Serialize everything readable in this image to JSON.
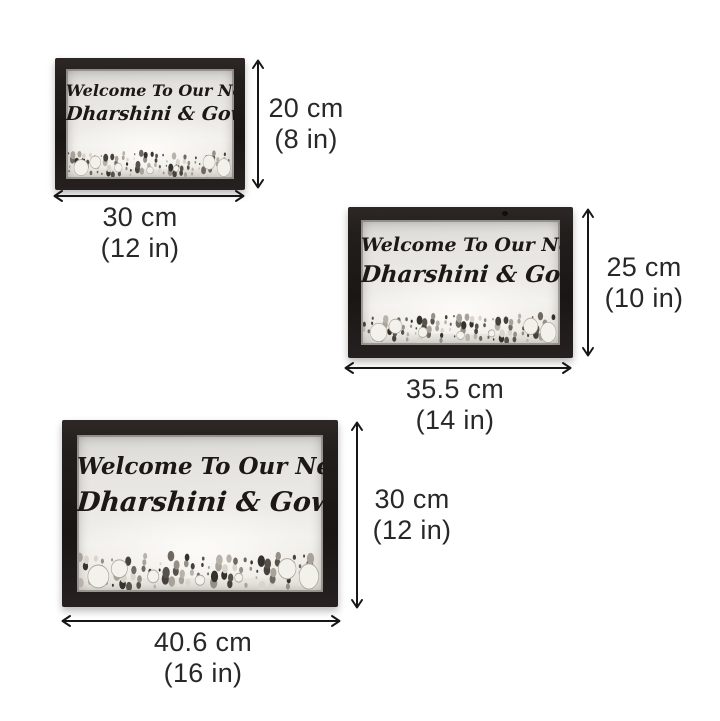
{
  "product": {
    "sign": {
      "line1": "Welcome To Our Nest",
      "line2": "Dharshini & Gowtham"
    }
  },
  "sizes": [
    {
      "label": "small",
      "height": {
        "value": "20 cm",
        "alt": "(8 in)"
      },
      "width": {
        "value": "30 cm",
        "alt": "(12 in)"
      }
    },
    {
      "label": "medium",
      "height": {
        "value": "25 cm",
        "alt": "(10 in)"
      },
      "width": {
        "value": "35.5 cm",
        "alt": "(14 in)"
      }
    },
    {
      "label": "large",
      "height": {
        "value": "30 cm",
        "alt": "(12 in)"
      },
      "width": {
        "value": "40.6 cm",
        "alt": "(16 in)"
      }
    }
  ],
  "colors": {
    "page_bg": "#ffffff",
    "frame_color": "#221e1b",
    "sign_text": "#1b1815",
    "dim_text": "#282828",
    "arrow_color": "#161616"
  }
}
